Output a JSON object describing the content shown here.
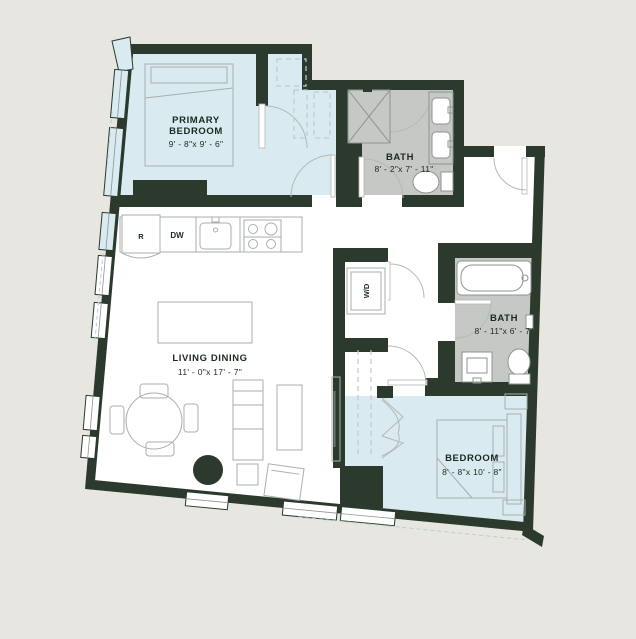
{
  "title": "Apartment floor plan",
  "colors": {
    "bg": "#e7e6e1",
    "wall": "#2b3a2c",
    "blue": "#d9eaf0",
    "gray": "#c5c8c5",
    "white": "#ffffff",
    "fixture": "#8d948f",
    "furniture": "#a9b0ab",
    "door": "#b3b9b3",
    "dash": "#b9cdd4",
    "text": "#1b2a1e"
  },
  "rooms": {
    "primary_bedroom": {
      "label_line1": "PRIMARY",
      "label_line2": "BEDROOM",
      "dims": "9' - 8\"x 9' - 6\""
    },
    "bath1": {
      "label": "BATH",
      "dims": "8' - 2\"x 7' - 11\""
    },
    "living_dining": {
      "label": "LIVING DINING",
      "dims": "11' - 0\"x 17' - 7\""
    },
    "bath2": {
      "label": "BATH",
      "dims": "8' - 11\"x 6' - 7\""
    },
    "bedroom": {
      "label": "BEDROOM",
      "dims": "8' - 8\"x 10' - 8\""
    }
  },
  "appliances": {
    "refrigerator": "R",
    "dishwasher": "DW",
    "washer_dryer": "W/D"
  }
}
